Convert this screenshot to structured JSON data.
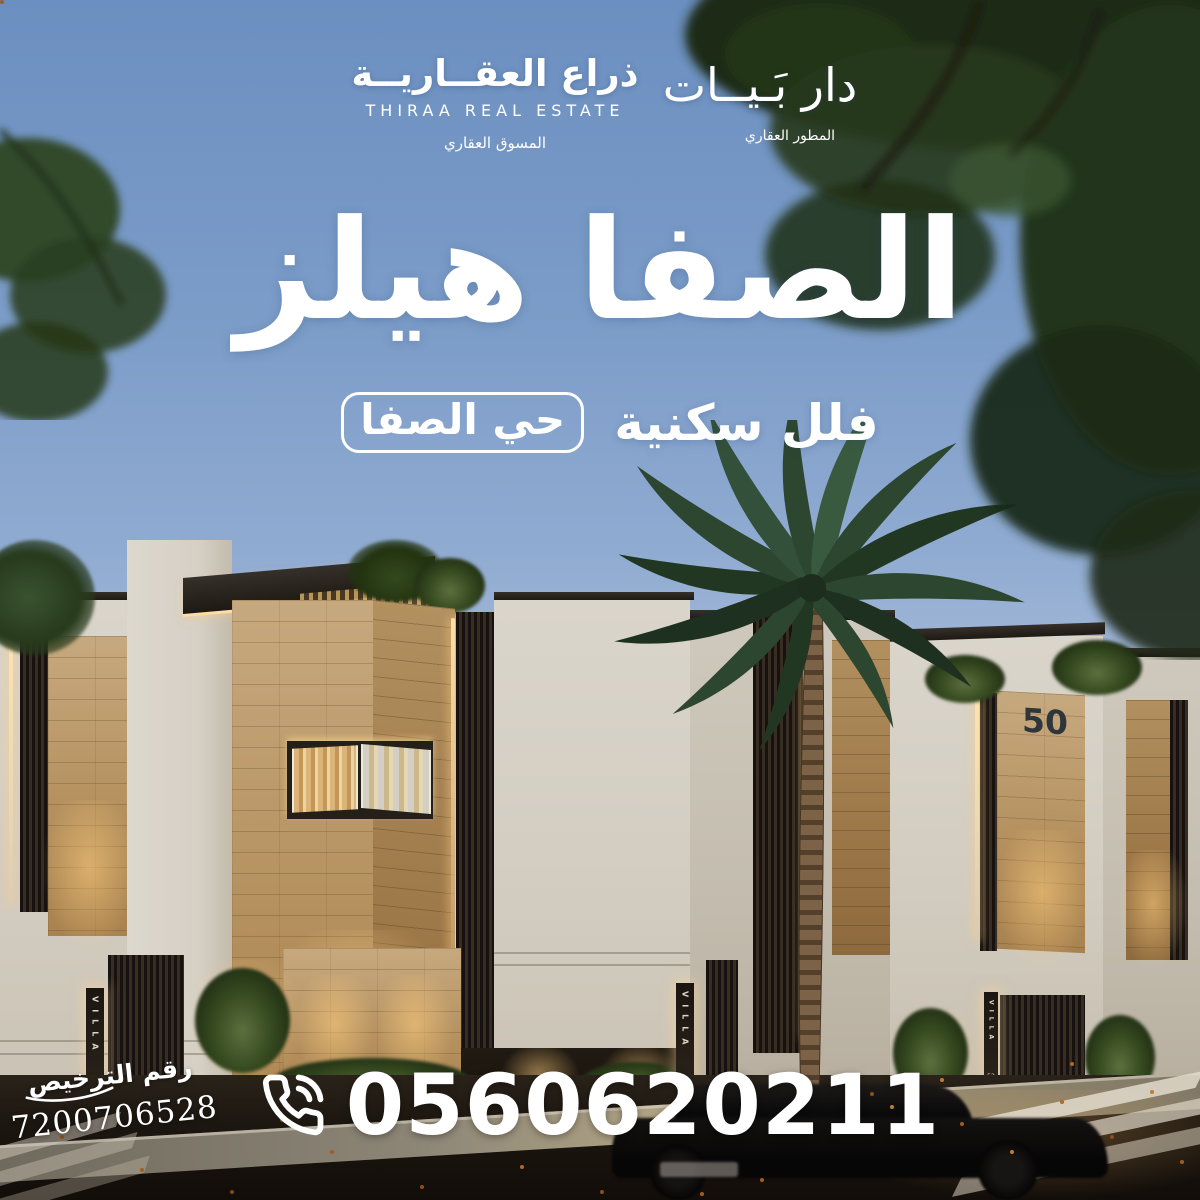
{
  "brand_bar": {
    "marketer": {
      "name_ar": "ذراع العقــاريــة",
      "name_en": "THIRAA REAL ESTATE",
      "tagline_ar": "المسوق العقاري"
    },
    "developer": {
      "name_ar": "دار بَـيــات",
      "tagline_ar": "المطور العقاري"
    }
  },
  "hero": {
    "project_title_ar": "الصفا هيلز",
    "subtitle_ar": "فلل سكنية",
    "district_badge_ar": "حي الصفا"
  },
  "contact": {
    "phone_number": "0560620211",
    "phone_icon": "phone-call-icon"
  },
  "license": {
    "label_ar": "رقم الترخيص",
    "number": "7200706528"
  },
  "scene": {
    "villa_sign": {
      "label": "VILLA",
      "number": "52"
    },
    "house_number": "50"
  },
  "colors": {
    "sky_top": "#6B8FC0",
    "sky_horizon": "#B8C8DE",
    "wall_white": "#D8D3C9",
    "travertine": "#B3905F",
    "warm_light": "#FFD79B",
    "text_white": "#FFFFFF"
  }
}
